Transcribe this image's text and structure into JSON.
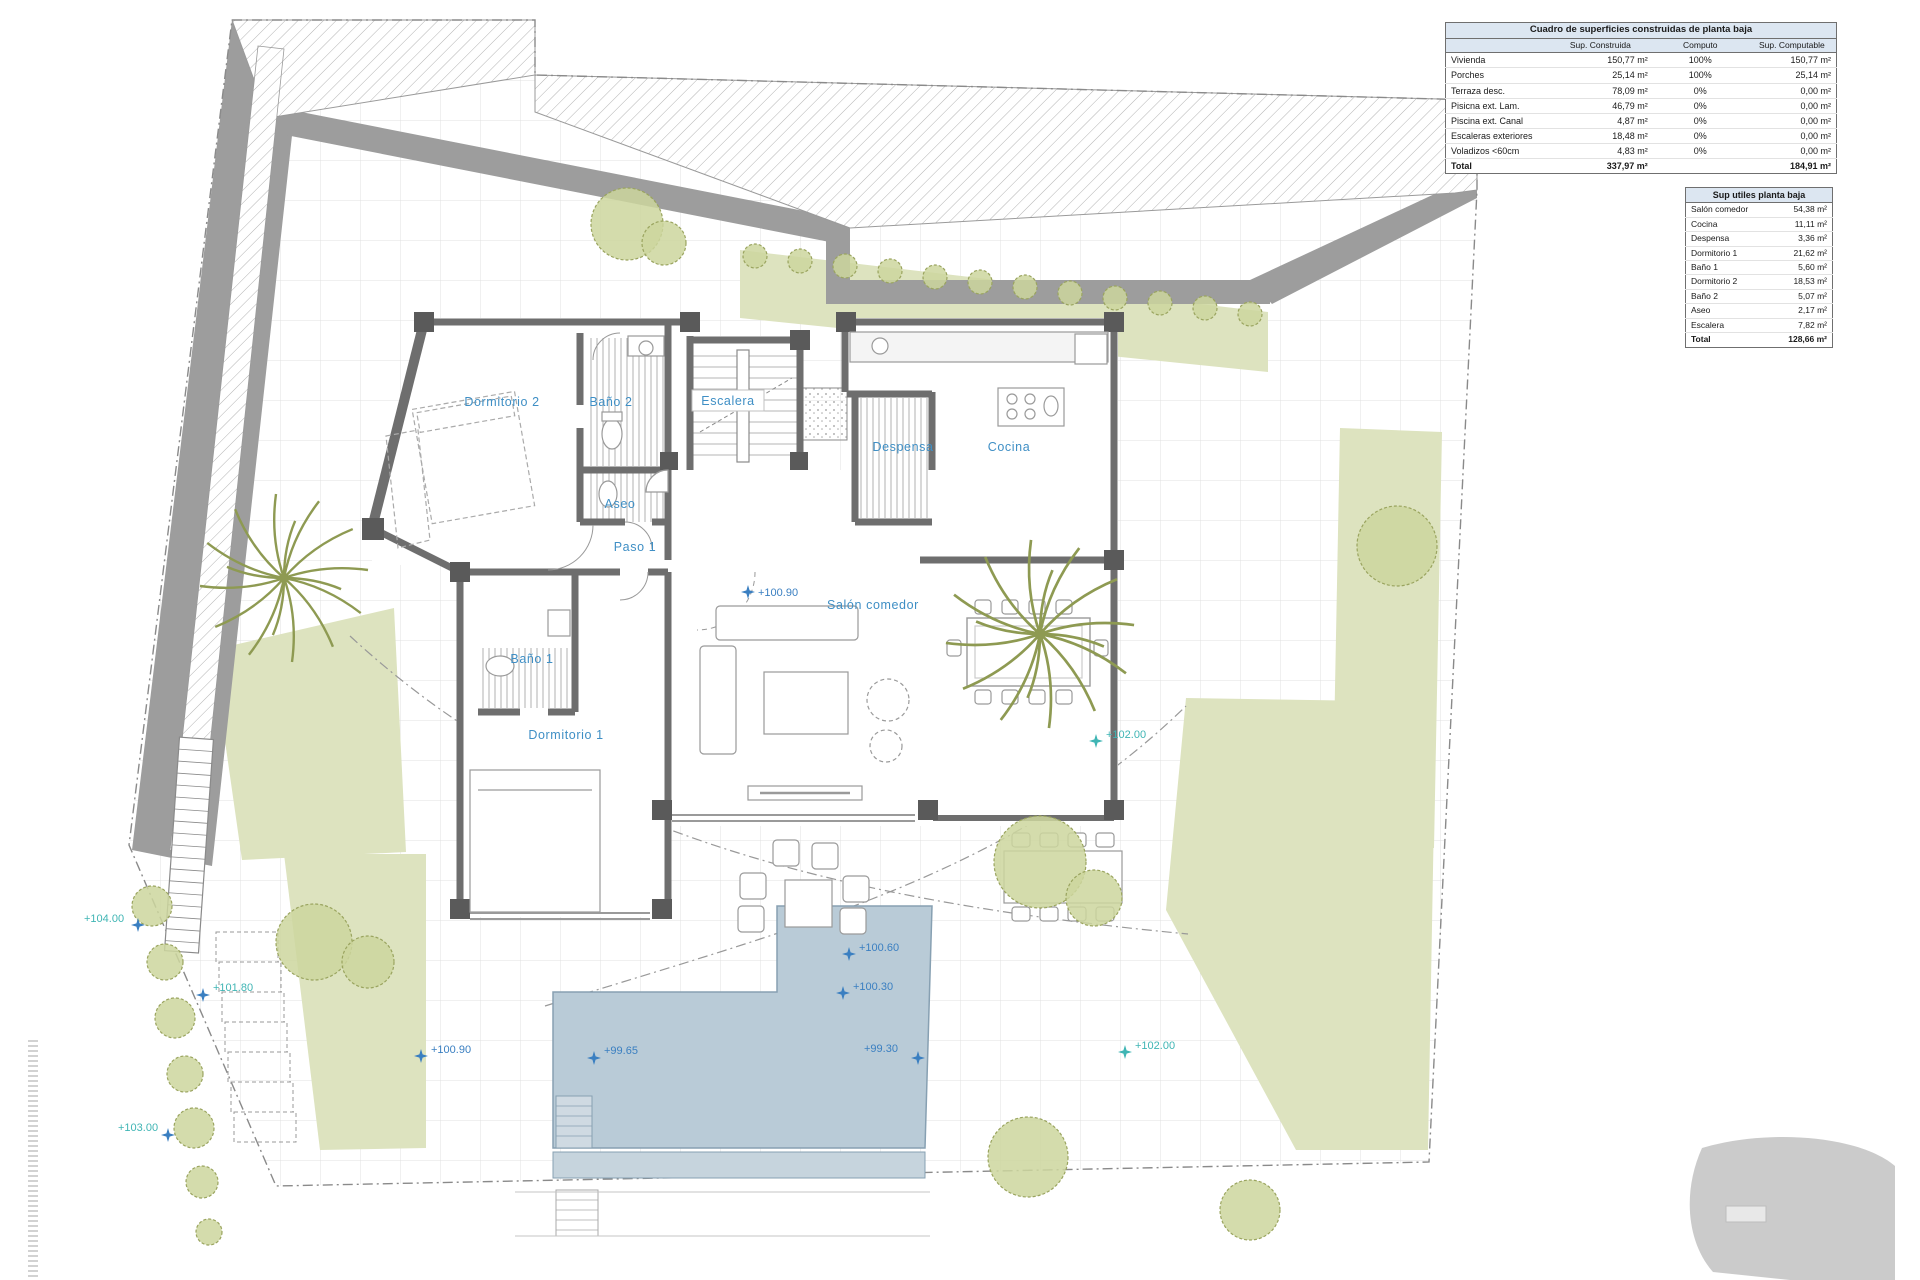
{
  "tables": {
    "construidas": {
      "title": "Cuadro de superficies construidas de planta baja",
      "columns": [
        "",
        "Sup. Construida",
        "Computo",
        "Sup. Computable"
      ],
      "rows": [
        {
          "label": "Vivienda",
          "sup": "150,77 m²",
          "computo": "100%",
          "computable": "150,77 m²"
        },
        {
          "label": "Porches",
          "sup": "25,14 m²",
          "computo": "100%",
          "computable": "25,14 m²"
        },
        {
          "label": "Terraza desc.",
          "sup": "78,09 m²",
          "computo": "0%",
          "computable": "0,00 m²"
        },
        {
          "label": "Pisicna ext. Lam.",
          "sup": "46,79 m²",
          "computo": "0%",
          "computable": "0,00 m²"
        },
        {
          "label": "Piscina ext. Canal",
          "sup": "4,87 m²",
          "computo": "0%",
          "computable": "0,00 m²"
        },
        {
          "label": "Escaleras exteriores",
          "sup": "18,48 m²",
          "computo": "0%",
          "computable": "0,00 m²"
        },
        {
          "label": "Voladizos <60cm",
          "sup": "4,83 m²",
          "computo": "0%",
          "computable": "0,00 m²"
        }
      ],
      "total": {
        "label": "Total",
        "sup": "337,97 m²",
        "computo": "",
        "computable": "184,91 m²"
      }
    },
    "utiles": {
      "title": "Sup utiles planta baja",
      "rows": [
        {
          "label": "Salón comedor",
          "value": "54,38 m²"
        },
        {
          "label": "Cocina",
          "value": "11,11 m²"
        },
        {
          "label": "Despensa",
          "value": "3,36 m²"
        },
        {
          "label": "Dormitorio 1",
          "value": "21,62 m²"
        },
        {
          "label": "Baño 1",
          "value": "5,60 m²"
        },
        {
          "label": "Dormitorio 2",
          "value": "18,53 m²"
        },
        {
          "label": "Baño 2",
          "value": "5,07 m²"
        },
        {
          "label": "Aseo",
          "value": "2,17 m²"
        },
        {
          "label": "Escalera",
          "value": "7,82 m²"
        }
      ],
      "total": {
        "label": "Total",
        "value": "128,66 m²"
      }
    }
  },
  "plan": {
    "rooms": [
      {
        "label": "Dormitorio 2"
      },
      {
        "label": "Baño 2"
      },
      {
        "label": "Escalera"
      },
      {
        "label": "Despensa"
      },
      {
        "label": "Cocina"
      },
      {
        "label": "Aseo"
      },
      {
        "label": "Paso 1"
      },
      {
        "label": "Salón comedor"
      },
      {
        "label": "Baño 1"
      },
      {
        "label": "Dormitorio 1"
      }
    ],
    "markers": [
      {
        "label": "+100.90",
        "type": "blue"
      },
      {
        "label": "+104.00",
        "type": "teal"
      },
      {
        "label": "+101.80",
        "type": "teal"
      },
      {
        "label": "+103.00",
        "type": "teal"
      },
      {
        "label": "+100.90",
        "type": "blue"
      },
      {
        "label": "+99.65",
        "type": "blue"
      },
      {
        "label": "+99.30",
        "type": "blue"
      },
      {
        "label": "+100.30",
        "type": "blue"
      },
      {
        "label": "+100.60",
        "type": "blue"
      },
      {
        "label": "+102.00",
        "type": "teal"
      },
      {
        "label": "+102.00",
        "type": "teal"
      }
    ],
    "colors": {
      "room_label": "#3f8fc5",
      "marker_blue": "#3a7fc1",
      "marker_teal": "#3fb5b4",
      "pool_fill": "#b9cbd7",
      "garden_fill": "#dde3bf",
      "perimeter_band": "#9d9d9d",
      "wall_gray": "#6e6e6e",
      "table_header_bg": "#dce6f1"
    }
  }
}
